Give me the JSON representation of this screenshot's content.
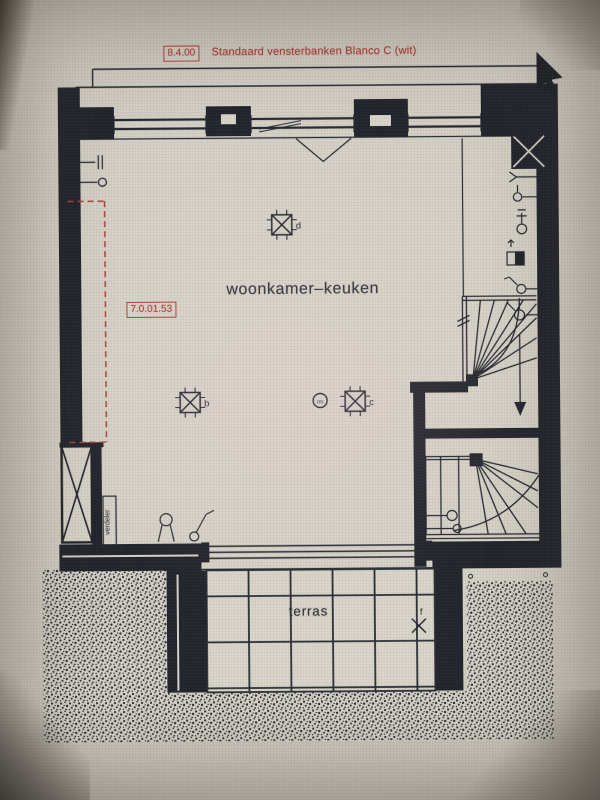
{
  "colors": {
    "background": "#d6d2c7",
    "ink": "#23272f",
    "wall_fill": "#20242c",
    "red_annotation": "#ad403b",
    "paper": "#d9d5ca"
  },
  "annotation": {
    "code": "8.4.00",
    "text": "Standaard vensterbanken Blanco C (wit)"
  },
  "rooms": {
    "living_kitchen": "woonkamer–keuken",
    "terrace": "terras"
  },
  "tags": {
    "ref_code": "7.0.01.53",
    "distribution_box": "verdeler"
  },
  "fixtures": {
    "light_d": "d",
    "light_b": "b",
    "light_c": "c",
    "light_f": "f",
    "smoke_detector": "rm"
  }
}
